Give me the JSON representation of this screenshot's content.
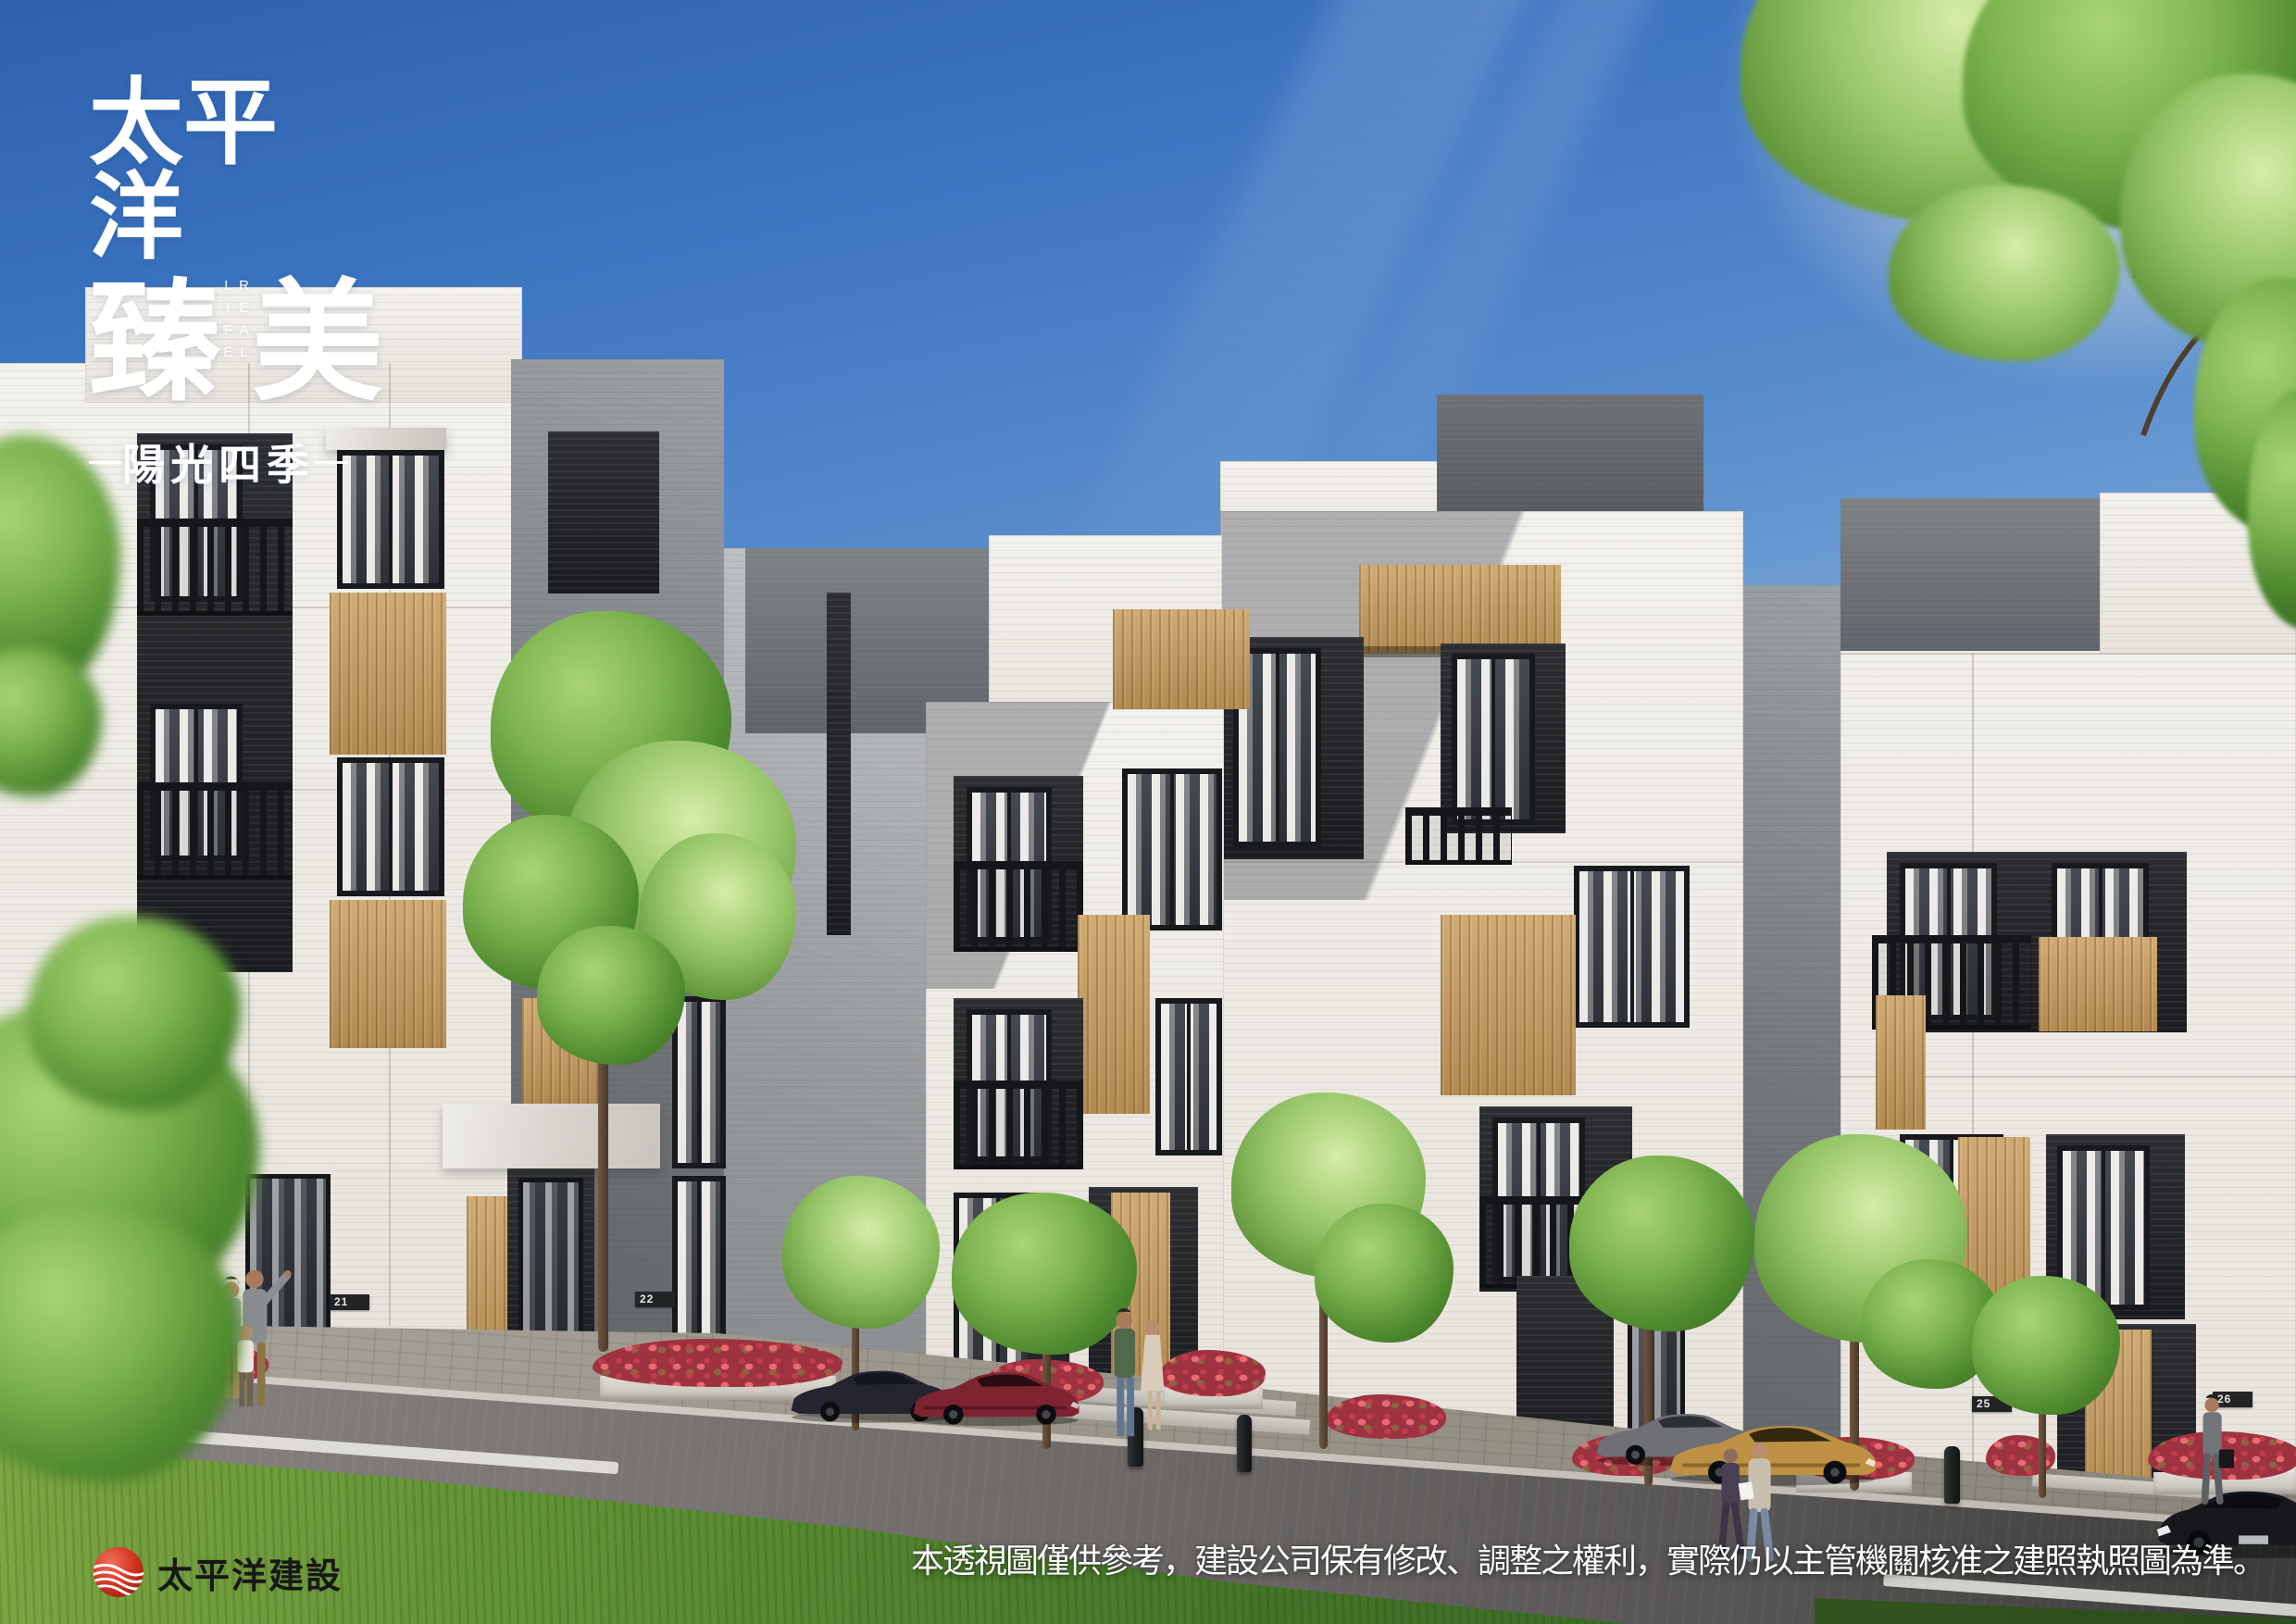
{
  "logo": {
    "line1": "太平洋",
    "line2_left": "臻",
    "line2_right": "美",
    "vertical_caption": "REAL LIFE",
    "subtitle": "陽光四季"
  },
  "footer": {
    "company_name": "太平洋建設",
    "logo_icon": "red-wave-sphere-logo",
    "disclaimer": "本透視圖僅供參考，建設公司保有修改、調整之權利，實際仍以主管機關核准之建照執照圖為準。"
  },
  "scene": {
    "house_numbers": [
      "21",
      "22",
      "25",
      "26"
    ],
    "colors": {
      "sky_top": "#2d61ae",
      "sky_horizon": "#eef3f8",
      "facade_white": "#efece7",
      "facade_gray": "#84888b",
      "roof_dark_gray": "#60646a",
      "window_dark": "#1b1d20",
      "wood_accent": "#c3a06a",
      "balcony_dark": "#141619",
      "grass_green": "#639437",
      "road_gray": "#6b6866",
      "flower_red": "#d24f57",
      "brand_red": "#d03a28",
      "logo_text": "#ffffff",
      "company_text": "#181818"
    }
  }
}
